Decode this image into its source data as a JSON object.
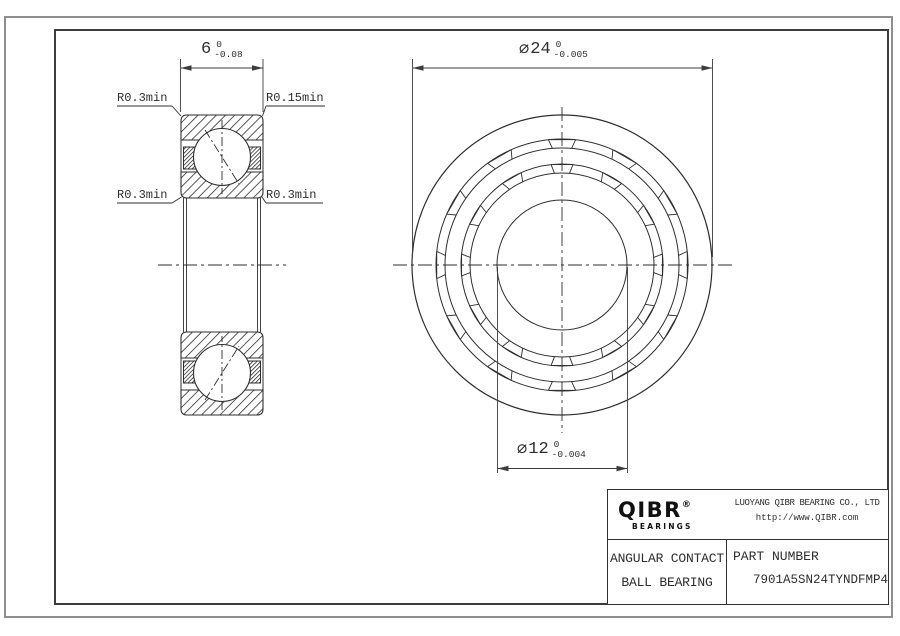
{
  "drawing": {
    "dims": {
      "width": {
        "symbol": "",
        "value": "6",
        "tol_upper": "0",
        "tol_lower": "-0.08"
      },
      "outer_diameter": {
        "symbol": "⌀",
        "value": "24",
        "tol_upper": "0",
        "tol_lower": "-0.005"
      },
      "bore_diameter": {
        "symbol": "⌀",
        "value": "12",
        "tol_upper": "0",
        "tol_lower": "-0.004"
      }
    },
    "callouts": {
      "top_left": "R0.3min",
      "top_right": "R0.15min",
      "mid_left": "R0.3min",
      "mid_right": "R0.3min"
    }
  },
  "title_block": {
    "logo": {
      "brand": "QIBR",
      "registered": "®",
      "subtitle": "BEARINGS"
    },
    "company_name": "LUOYANG QIBR BEARING CO., LTD",
    "website": "http://www.QIBR.com",
    "product_type_line1": "ANGULAR CONTACT",
    "product_type_line2": "BALL BEARING",
    "part_number_label": "PART NUMBER",
    "part_number": "7901A5SN24TYNDFMP4"
  },
  "colors": {
    "line": "#2e2e2e",
    "dim_line": "#3c3c3c",
    "frame": "#3d3d3d",
    "page_border": "#8f8f8f"
  }
}
